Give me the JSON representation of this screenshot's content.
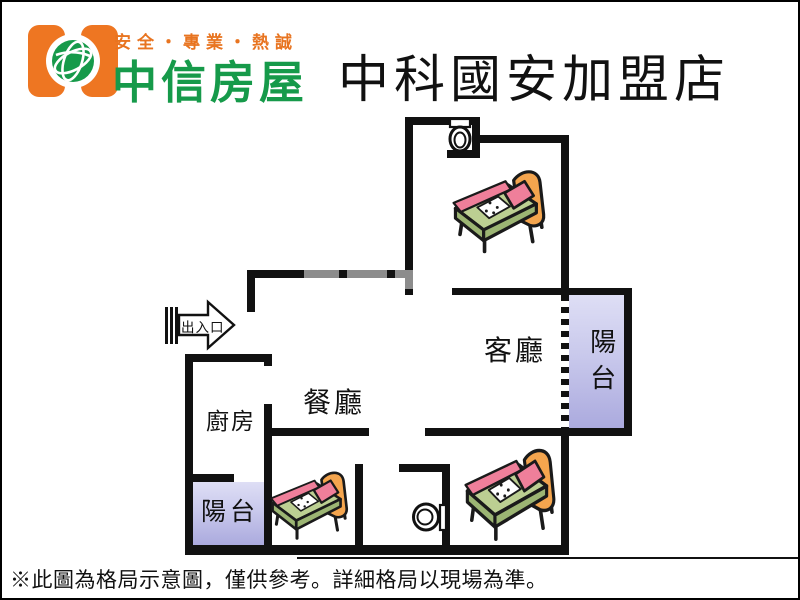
{
  "header": {
    "slogan": "安全・專業・熱誠",
    "brand": "中信房屋",
    "store_title": "中科國安加盟店"
  },
  "floorplan": {
    "rooms": {
      "living": "客廳",
      "dining": "餐廳",
      "kitchen": "廚房",
      "balcony_left": "陽台",
      "balcony_right": "陽台"
    },
    "entrance_label": "出入口",
    "furniture": {
      "beds": 3,
      "toilets": 2
    }
  },
  "footer": {
    "disclaimer": "※此圖為格局示意圖，僅供參考。詳細格局以現場為準。"
  },
  "colors": {
    "wall": "#111111",
    "window_wall_gray": "#8c8c8c",
    "balcony_fill_top": "#dedef5",
    "balcony_fill_bottom": "#abaade",
    "brand_green": "#169a4a",
    "brand_orange": "#e87420",
    "bed_green": "#bccf92",
    "bed_dark_green": "#9cb573",
    "bed_pink": "#ef7f9a",
    "bed_headboard_orange": "#f4a54e",
    "text_black": "#111111"
  }
}
